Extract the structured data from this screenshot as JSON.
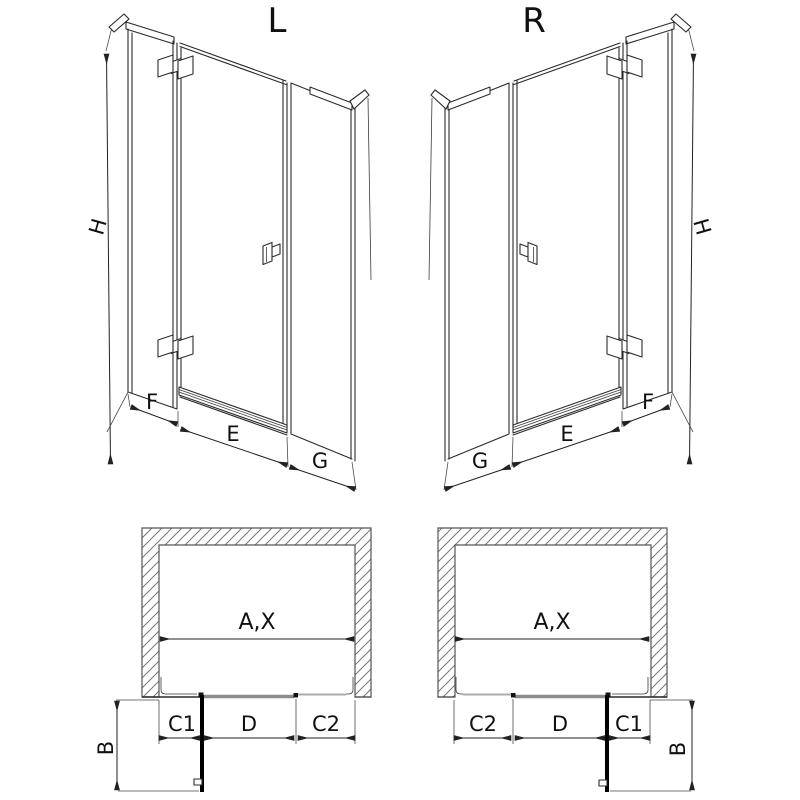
{
  "diagram": {
    "type": "shower-enclosure-technical-drawing",
    "variants": {
      "left": {
        "title": "L"
      },
      "right": {
        "title": "R"
      }
    },
    "dimension_labels": {
      "height": "H",
      "fixed_panel": "F",
      "door_width": "E",
      "return_panel": "G",
      "total_width": "A,X",
      "hinge_side_fixed": "C1",
      "door_opening": "D",
      "latch_side_fixed": "C2",
      "depth": "B"
    },
    "colors": {
      "line": "#2b2b2b",
      "hatch": "#777777",
      "track_dark": "#8c8c8c",
      "track_light": "#ababab",
      "open_door": "#000000",
      "background": "#ffffff"
    }
  }
}
